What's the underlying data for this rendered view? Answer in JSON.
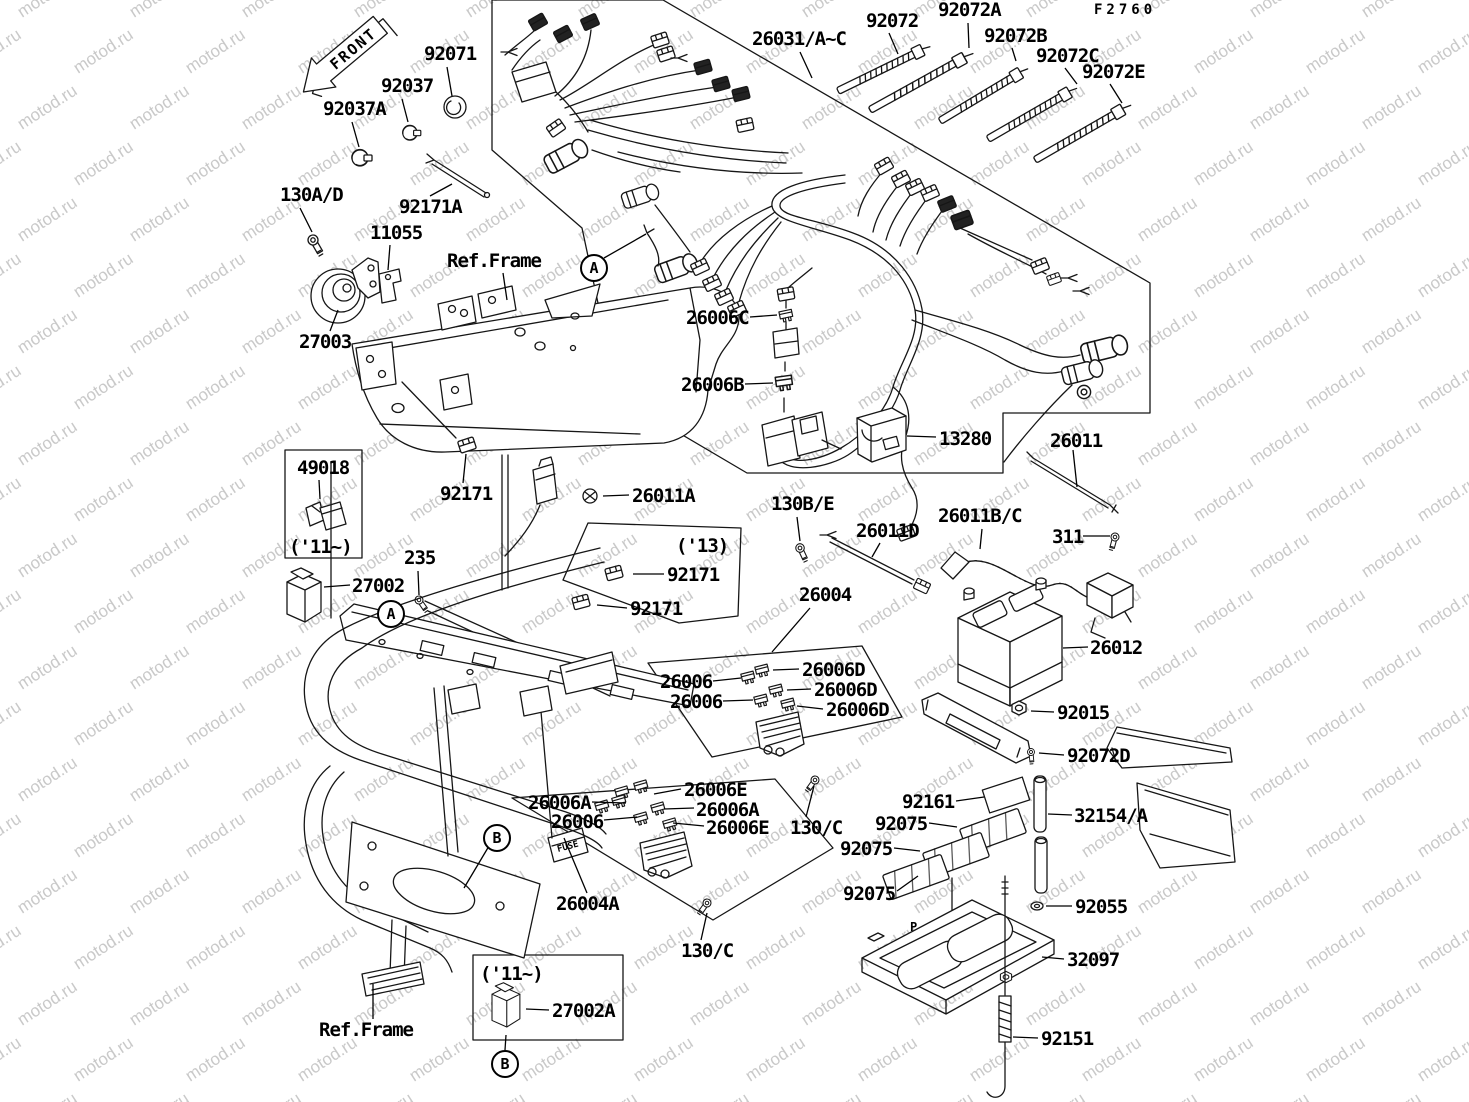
{
  "title": "electrical equipment parts diagram",
  "figure_code": "F2760",
  "watermark": {
    "text": "motod.ru"
  },
  "front_arrow": {
    "label": "FRONT"
  },
  "callouts": [
    {
      "text": "A",
      "x": 592,
      "y": 266,
      "leader": [
        604,
        258,
        646,
        234
      ]
    },
    {
      "text": "A",
      "x": 389,
      "y": 612
    },
    {
      "text": "B",
      "x": 495,
      "y": 836,
      "leader": [
        489,
        846,
        464,
        888
      ]
    },
    {
      "text": "B",
      "x": 503,
      "y": 1062,
      "leader": [
        505,
        1050,
        506,
        1035
      ]
    }
  ],
  "labels": [
    {
      "text": "F2760",
      "x": 1094,
      "y": 3,
      "cls": "small"
    },
    {
      "text": "92071",
      "x": 424,
      "y": 45,
      "leader": [
        447,
        67,
        452,
        96
      ]
    },
    {
      "text": "92037",
      "x": 381,
      "y": 77,
      "leader": [
        402,
        99,
        408,
        122
      ]
    },
    {
      "text": "92037A",
      "x": 323,
      "y": 100,
      "leader": [
        352,
        122,
        359,
        147
      ]
    },
    {
      "text": "130A/D",
      "x": 280,
      "y": 186,
      "leader": [
        300,
        208,
        312,
        232
      ]
    },
    {
      "text": "92171A",
      "x": 399,
      "y": 198,
      "leader": [
        430,
        196,
        452,
        184
      ]
    },
    {
      "text": "11055",
      "x": 370,
      "y": 224,
      "leader": [
        390,
        245,
        388,
        270
      ]
    },
    {
      "text": "Ref.Frame",
      "x": 447,
      "y": 252,
      "leader": [
        503,
        273,
        507,
        300
      ]
    },
    {
      "text": "27003",
      "x": 299,
      "y": 333,
      "leader": [
        330,
        331,
        338,
        310
      ]
    },
    {
      "text": "26031/A~C",
      "x": 752,
      "y": 30,
      "leader": [
        800,
        52,
        812,
        78
      ]
    },
    {
      "text": "92072",
      "x": 866,
      "y": 12,
      "leader": [
        889,
        33,
        898,
        54
      ]
    },
    {
      "text": "92072A",
      "x": 938,
      "y": 1,
      "leader": [
        968,
        23,
        969,
        48
      ]
    },
    {
      "text": "92072B",
      "x": 984,
      "y": 27,
      "leader": [
        1012,
        48,
        1016,
        61
      ]
    },
    {
      "text": "92072C",
      "x": 1036,
      "y": 47,
      "leader": [
        1065,
        68,
        1077,
        84
      ]
    },
    {
      "text": "92072E",
      "x": 1082,
      "y": 63,
      "leader": [
        1110,
        84,
        1122,
        103
      ]
    },
    {
      "text": "26006C",
      "x": 686,
      "y": 309,
      "leader": [
        750,
        317,
        777,
        315
      ]
    },
    {
      "text": "26006B",
      "x": 681,
      "y": 376,
      "leader": [
        745,
        384,
        773,
        383
      ]
    },
    {
      "text": "13280",
      "x": 939,
      "y": 430,
      "leader": [
        936,
        437,
        907,
        436
      ]
    },
    {
      "text": "26011",
      "x": 1050,
      "y": 432,
      "leader": [
        1073,
        450,
        1077,
        487
      ]
    },
    {
      "text": "49018",
      "x": 297,
      "y": 459,
      "leader": [
        319,
        480,
        320,
        499
      ]
    },
    {
      "text": "('11~)",
      "x": 289,
      "y": 538
    },
    {
      "text": "92171",
      "x": 440,
      "y": 485,
      "leader": [
        463,
        483,
        466,
        454
      ]
    },
    {
      "text": "26011A",
      "x": 632,
      "y": 487,
      "leader": [
        629,
        495,
        603,
        496
      ]
    },
    {
      "text": "('13)",
      "x": 676,
      "y": 537
    },
    {
      "text": "92171",
      "x": 667,
      "y": 566,
      "leader": [
        664,
        574,
        633,
        574
      ]
    },
    {
      "text": "92171",
      "x": 630,
      "y": 600,
      "leader": [
        627,
        608,
        597,
        605
      ]
    },
    {
      "text": "130B/E",
      "x": 771,
      "y": 495,
      "leader": [
        797,
        517,
        800,
        541
      ]
    },
    {
      "text": "26011D",
      "x": 856,
      "y": 522,
      "leader": [
        880,
        543,
        872,
        557
      ]
    },
    {
      "text": "26011B/C",
      "x": 938,
      "y": 507,
      "leader": [
        982,
        529,
        980,
        549
      ]
    },
    {
      "text": "311",
      "x": 1052,
      "y": 528,
      "leader": [
        1083,
        536,
        1110,
        536
      ]
    },
    {
      "text": "235",
      "x": 404,
      "y": 549,
      "leader": [
        418,
        571,
        419,
        595
      ]
    },
    {
      "text": "27002",
      "x": 352,
      "y": 577,
      "leader": [
        350,
        585,
        324,
        587
      ]
    },
    {
      "text": "26004",
      "x": 799,
      "y": 586,
      "leader": [
        810,
        608,
        772,
        652
      ]
    },
    {
      "text": "26012",
      "x": 1090,
      "y": 639,
      "leader": [
        1088,
        647,
        1063,
        648
      ]
    },
    {
      "text": "26006D",
      "x": 802,
      "y": 661,
      "leader": [
        799,
        669,
        773,
        670
      ]
    },
    {
      "text": "26006",
      "x": 660,
      "y": 673,
      "leader": [
        713,
        681,
        741,
        678
      ]
    },
    {
      "text": "26006D",
      "x": 814,
      "y": 681,
      "leader": [
        811,
        689,
        787,
        690
      ]
    },
    {
      "text": "26006",
      "x": 670,
      "y": 693,
      "leader": [
        723,
        701,
        753,
        700
      ]
    },
    {
      "text": "26006D",
      "x": 826,
      "y": 701,
      "leader": [
        823,
        709,
        797,
        706
      ]
    },
    {
      "text": "92015",
      "x": 1057,
      "y": 704,
      "leader": [
        1054,
        712,
        1031,
        711
      ]
    },
    {
      "text": "92072D",
      "x": 1067,
      "y": 747,
      "leader": [
        1064,
        755,
        1039,
        753
      ]
    },
    {
      "text": "92161",
      "x": 902,
      "y": 793,
      "leader": [
        956,
        801,
        984,
        797
      ]
    },
    {
      "text": "32154/A",
      "x": 1074,
      "y": 807,
      "leader": [
        1072,
        815,
        1048,
        814
      ]
    },
    {
      "text": "92075",
      "x": 875,
      "y": 815,
      "leader": [
        929,
        823,
        957,
        827
      ]
    },
    {
      "text": "92075",
      "x": 840,
      "y": 840,
      "leader": [
        894,
        848,
        920,
        851
      ]
    },
    {
      "text": "92075",
      "x": 843,
      "y": 885,
      "leader": [
        897,
        891,
        918,
        876
      ]
    },
    {
      "text": "26006E",
      "x": 684,
      "y": 781,
      "leader": [
        681,
        789,
        654,
        794
      ]
    },
    {
      "text": "26006A",
      "x": 528,
      "y": 794,
      "leader": [
        592,
        802,
        626,
        803
      ]
    },
    {
      "text": "26006A",
      "x": 696,
      "y": 801,
      "leader": [
        694,
        808,
        664,
        809
      ]
    },
    {
      "text": "26006",
      "x": 551,
      "y": 813,
      "leader": [
        604,
        820,
        637,
        817
      ]
    },
    {
      "text": "26006E",
      "x": 706,
      "y": 819,
      "leader": [
        704,
        826,
        673,
        823
      ]
    },
    {
      "text": "130/C",
      "x": 790,
      "y": 819,
      "leader": [
        806,
        817,
        814,
        786
      ]
    },
    {
      "text": "92055",
      "x": 1075,
      "y": 898,
      "leader": [
        1072,
        906,
        1046,
        906
      ]
    },
    {
      "text": "26004A",
      "x": 556,
      "y": 895,
      "leader": [
        587,
        893,
        564,
        838
      ]
    },
    {
      "text": "130/C",
      "x": 681,
      "y": 942,
      "leader": [
        701,
        940,
        707,
        913
      ]
    },
    {
      "text": "32097",
      "x": 1067,
      "y": 951,
      "leader": [
        1064,
        959,
        1042,
        957
      ]
    },
    {
      "text": "Ref.Frame",
      "x": 319,
      "y": 1021,
      "leader": [
        373,
        1019,
        373,
        984
      ]
    },
    {
      "text": "('11~)",
      "x": 480,
      "y": 965
    },
    {
      "text": "27002A",
      "x": 552,
      "y": 1002,
      "leader": [
        549,
        1010,
        526,
        1009
      ]
    },
    {
      "text": "92151",
      "x": 1041,
      "y": 1030,
      "leader": [
        1038,
        1038,
        1013,
        1037
      ]
    },
    {
      "text": "P",
      "x": 910,
      "y": 921,
      "cls": "tiny"
    }
  ]
}
